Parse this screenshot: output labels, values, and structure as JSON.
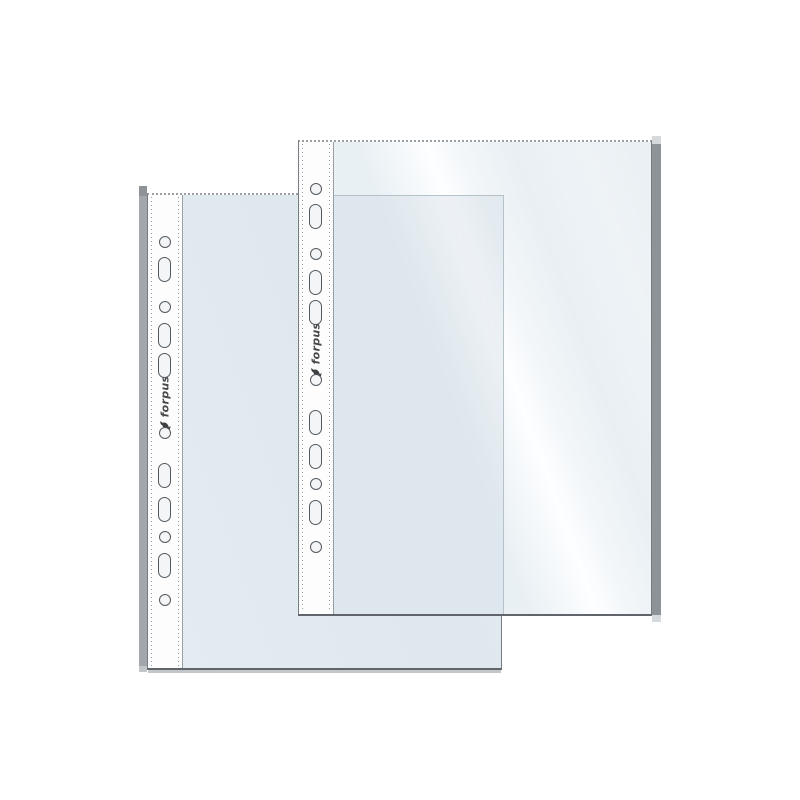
{
  "image": {
    "background_color": "#ffffff",
    "subject": "two transparent punched pockets with brand strip"
  },
  "brand": {
    "logo_text": "forpus"
  },
  "sheets": [
    {
      "id": "back-sheet",
      "logo": "forpus"
    },
    {
      "id": "front-sheet",
      "logo": "forpus"
    }
  ],
  "holes": {
    "count_per_sheet": 11,
    "pattern": [
      "circle",
      "oval",
      "circle",
      "oval",
      "oval",
      "circle",
      "oval",
      "oval",
      "circle",
      "oval",
      "circle"
    ],
    "offsets_px": [
      47,
      74,
      112,
      140,
      170,
      238,
      280,
      314,
      342,
      370,
      405
    ]
  },
  "colors": {
    "bg": "#ffffff",
    "film_back": "#dfe8ed",
    "film_front": "#e9f0f4",
    "strip": "#fdfdfd",
    "hole_outline": "#54595e",
    "hole_fill": "#f3f5f6",
    "dots": "#9aa0a4",
    "fold_front": "#8e9397",
    "fold_back": "#a3a7ab",
    "edge": "#767c81",
    "showthrough": "#b6c2ca"
  }
}
